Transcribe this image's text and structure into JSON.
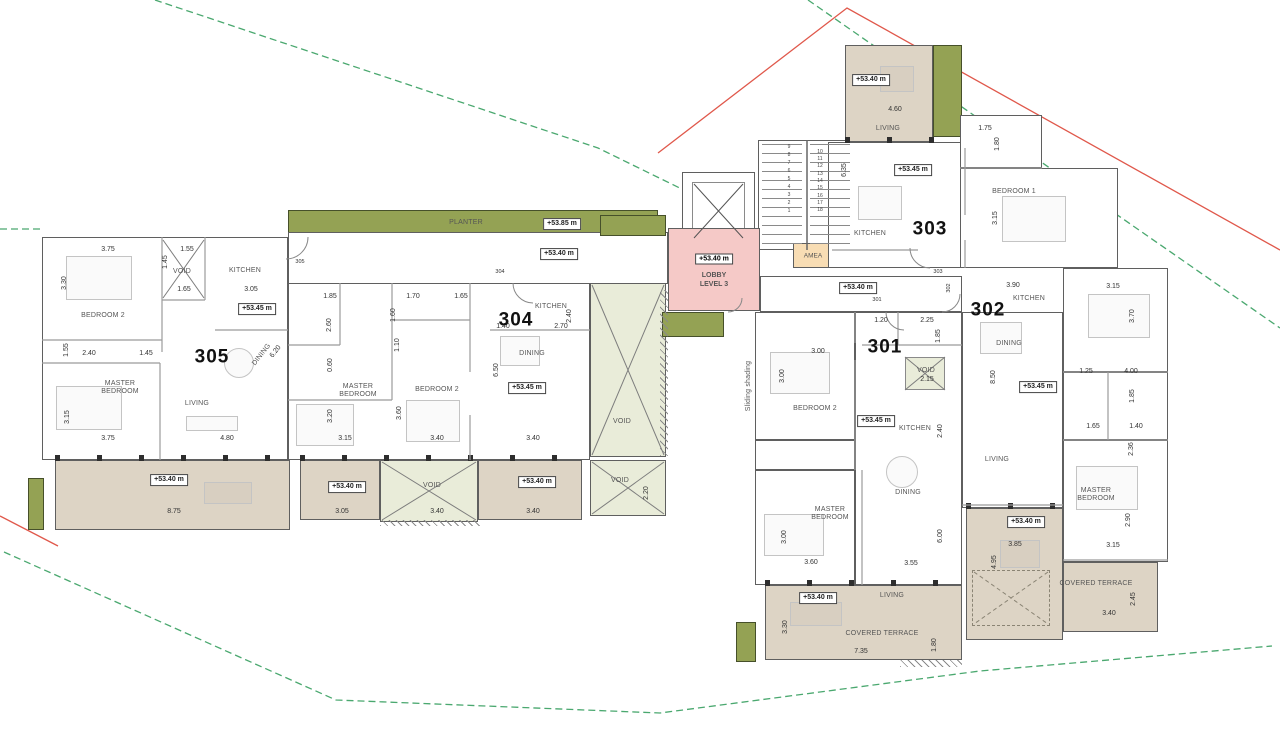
{
  "colors": {
    "terrace": "#ddd4c5",
    "planter": "#94a254",
    "void": "#e9ecd9",
    "lobby": "#f5c9c7",
    "amea": "#f8ddb4",
    "boundary_green": "#4aa86f",
    "boundary_red": "#e0584b"
  },
  "lobby": {
    "elevation": "+53.40 m",
    "line1": "LOBBY",
    "line2": "LEVEL 3"
  },
  "amea": {
    "label": "AMEA"
  },
  "labels": {
    "apartment_numbers": [
      {
        "t": "305",
        "x": 212,
        "y": 357
      },
      {
        "t": "304",
        "x": 516,
        "y": 320
      },
      {
        "t": "303",
        "x": 930,
        "y": 229
      },
      {
        "t": "302",
        "x": 988,
        "y": 310
      },
      {
        "t": "301",
        "x": 885,
        "y": 347
      }
    ],
    "rooms": [
      {
        "t": "BEDROOM 2",
        "x": 103,
        "y": 316
      },
      {
        "t": "VOID",
        "x": 182,
        "y": 272
      },
      {
        "t": "KITCHEN",
        "x": 245,
        "y": 271
      },
      {
        "t": "MASTER\nBEDROOM",
        "x": 120,
        "y": 388
      },
      {
        "t": "LIVING",
        "x": 197,
        "y": 404
      },
      {
        "t": "DINING",
        "x": 262,
        "y": 355,
        "r": -52
      },
      {
        "t": "PLANTER",
        "x": 466,
        "y": 223
      },
      {
        "t": "MASTER\nBEDROOM",
        "x": 358,
        "y": 391
      },
      {
        "t": "BEDROOM 2",
        "x": 437,
        "y": 390
      },
      {
        "t": "DINING",
        "x": 532,
        "y": 354
      },
      {
        "t": "KITCHEN",
        "x": 551,
        "y": 307
      },
      {
        "t": "VOID",
        "x": 432,
        "y": 486
      },
      {
        "t": "VOID",
        "x": 622,
        "y": 422
      },
      {
        "t": "VOID",
        "x": 620,
        "y": 481
      },
      {
        "t": "LIVING",
        "x": 888,
        "y": 129
      },
      {
        "t": "KITCHEN",
        "x": 870,
        "y": 234
      },
      {
        "t": "BEDROOM 1",
        "x": 1014,
        "y": 192
      },
      {
        "t": "KITCHEN",
        "x": 1029,
        "y": 299
      },
      {
        "t": "DINING",
        "x": 1009,
        "y": 344
      },
      {
        "t": "LIVING",
        "x": 997,
        "y": 460
      },
      {
        "t": "MASTER\nBEDROOM",
        "x": 1096,
        "y": 495
      },
      {
        "t": "COVERED TERRACE",
        "x": 1096,
        "y": 584
      },
      {
        "t": "BEDROOM 2",
        "x": 815,
        "y": 409
      },
      {
        "t": "VOID",
        "x": 926,
        "y": 371
      },
      {
        "t": "KITCHEN",
        "x": 915,
        "y": 429
      },
      {
        "t": "MASTER\nBEDROOM",
        "x": 830,
        "y": 514
      },
      {
        "t": "DINING",
        "x": 908,
        "y": 493
      },
      {
        "t": "LIVING",
        "x": 892,
        "y": 596
      },
      {
        "t": "COVERED TERRACE",
        "x": 882,
        "y": 634
      },
      {
        "t": "Sliding shading",
        "x": 749,
        "y": 386,
        "r": -90
      }
    ],
    "dims": [
      {
        "t": "3.75",
        "x": 108,
        "y": 250
      },
      {
        "t": "1.55",
        "x": 187,
        "y": 250
      },
      {
        "t": "1.45",
        "x": 166,
        "y": 262,
        "r": -90
      },
      {
        "t": "3.30",
        "x": 65,
        "y": 283,
        "r": -90
      },
      {
        "t": "1.65",
        "x": 184,
        "y": 290
      },
      {
        "t": "3.05",
        "x": 251,
        "y": 290
      },
      {
        "t": "1.55",
        "x": 67,
        "y": 350,
        "r": -90
      },
      {
        "t": "2.40",
        "x": 89,
        "y": 354
      },
      {
        "t": "1.45",
        "x": 146,
        "y": 354
      },
      {
        "t": "3.15",
        "x": 68,
        "y": 417,
        "r": -90
      },
      {
        "t": "3.75",
        "x": 108,
        "y": 439
      },
      {
        "t": "4.80",
        "x": 227,
        "y": 439
      },
      {
        "t": "8.75",
        "x": 174,
        "y": 512
      },
      {
        "t": "6.20",
        "x": 276,
        "y": 352,
        "r": -52
      },
      {
        "t": "1.85",
        "x": 330,
        "y": 297
      },
      {
        "t": "1.70",
        "x": 413,
        "y": 297
      },
      {
        "t": "1.65",
        "x": 461,
        "y": 297
      },
      {
        "t": "2.60",
        "x": 330,
        "y": 325,
        "r": -90
      },
      {
        "t": "1.60",
        "x": 394,
        "y": 315,
        "r": -90
      },
      {
        "t": "1.10",
        "x": 398,
        "y": 345,
        "r": -90
      },
      {
        "t": "0.60",
        "x": 331,
        "y": 365,
        "r": -90
      },
      {
        "t": "1.40",
        "x": 503,
        "y": 327
      },
      {
        "t": "2.70",
        "x": 561,
        "y": 327
      },
      {
        "t": "2.40",
        "x": 570,
        "y": 316,
        "r": -90
      },
      {
        "t": "3.20",
        "x": 331,
        "y": 416,
        "r": -90
      },
      {
        "t": "3.60",
        "x": 400,
        "y": 413,
        "r": -90
      },
      {
        "t": "3.15",
        "x": 345,
        "y": 439
      },
      {
        "t": "3.40",
        "x": 437,
        "y": 439
      },
      {
        "t": "3.40",
        "x": 533,
        "y": 439
      },
      {
        "t": "6.50",
        "x": 497,
        "y": 370,
        "r": -90
      },
      {
        "t": "3.05",
        "x": 342,
        "y": 512
      },
      {
        "t": "3.40",
        "x": 437,
        "y": 512
      },
      {
        "t": "3.40",
        "x": 533,
        "y": 512
      },
      {
        "t": "2.20",
        "x": 647,
        "y": 493,
        "r": -90
      },
      {
        "t": "6.35",
        "x": 845,
        "y": 170,
        "r": -90
      },
      {
        "t": "4.60",
        "x": 895,
        "y": 110
      },
      {
        "t": "1.75",
        "x": 985,
        "y": 129
      },
      {
        "t": "1.80",
        "x": 998,
        "y": 144,
        "r": -90
      },
      {
        "t": "3.15",
        "x": 996,
        "y": 218,
        "r": -90
      },
      {
        "t": "3.90",
        "x": 1013,
        "y": 286
      },
      {
        "t": "3.15",
        "x": 1113,
        "y": 287
      },
      {
        "t": "3.70",
        "x": 1133,
        "y": 316,
        "r": -90
      },
      {
        "t": "8.50",
        "x": 994,
        "y": 377,
        "r": -90
      },
      {
        "t": "1.25",
        "x": 1086,
        "y": 372
      },
      {
        "t": "4.00",
        "x": 1131,
        "y": 372
      },
      {
        "t": "1.85",
        "x": 1133,
        "y": 396,
        "r": -90
      },
      {
        "t": "1.65",
        "x": 1093,
        "y": 427
      },
      {
        "t": "1.40",
        "x": 1136,
        "y": 427
      },
      {
        "t": "2.36",
        "x": 1132,
        "y": 449,
        "r": -90
      },
      {
        "t": "2.90",
        "x": 1129,
        "y": 520,
        "r": -90
      },
      {
        "t": "3.15",
        "x": 1113,
        "y": 546
      },
      {
        "t": "3.85",
        "x": 1015,
        "y": 545
      },
      {
        "t": "4.95",
        "x": 995,
        "y": 562,
        "r": -90
      },
      {
        "t": "3.40",
        "x": 1109,
        "y": 614
      },
      {
        "t": "2.45",
        "x": 1134,
        "y": 599,
        "r": -90
      },
      {
        "t": "1.20",
        "x": 881,
        "y": 321
      },
      {
        "t": "2.25",
        "x": 927,
        "y": 321
      },
      {
        "t": "1.85",
        "x": 939,
        "y": 336,
        "r": -90
      },
      {
        "t": "3.00",
        "x": 818,
        "y": 352
      },
      {
        "t": "3.00",
        "x": 783,
        "y": 376,
        "r": -90
      },
      {
        "t": "2.15",
        "x": 927,
        "y": 380
      },
      {
        "t": "2.40",
        "x": 941,
        "y": 431,
        "r": -90
      },
      {
        "t": "3.00",
        "x": 785,
        "y": 537,
        "r": -90
      },
      {
        "t": "3.60",
        "x": 811,
        "y": 563
      },
      {
        "t": "6.00",
        "x": 941,
        "y": 536,
        "r": -90
      },
      {
        "t": "3.55",
        "x": 911,
        "y": 564
      },
      {
        "t": "3.30",
        "x": 786,
        "y": 627,
        "r": -90
      },
      {
        "t": "7.35",
        "x": 861,
        "y": 652
      },
      {
        "t": "1.80",
        "x": 935,
        "y": 645,
        "r": -90
      }
    ],
    "elevations": [
      {
        "t": "+53.85 m",
        "x": 562,
        "y": 224
      },
      {
        "t": "+53.40 m",
        "x": 559,
        "y": 254
      },
      {
        "t": "+53.45 m",
        "x": 257,
        "y": 309
      },
      {
        "t": "+53.40 m",
        "x": 169,
        "y": 480
      },
      {
        "t": "+53.45 m",
        "x": 527,
        "y": 388
      },
      {
        "t": "+53.40 m",
        "x": 347,
        "y": 487
      },
      {
        "t": "+53.40 m",
        "x": 537,
        "y": 482
      },
      {
        "t": "+53.40 m",
        "x": 858,
        "y": 288
      },
      {
        "t": "+53.40 m",
        "x": 871,
        "y": 80
      },
      {
        "t": "+53.45 m",
        "x": 913,
        "y": 170
      },
      {
        "t": "+53.45 m",
        "x": 1038,
        "y": 387
      },
      {
        "t": "+53.45 m",
        "x": 876,
        "y": 421
      },
      {
        "t": "+53.40 m",
        "x": 818,
        "y": 598
      },
      {
        "t": "+53.40 m",
        "x": 1026,
        "y": 522
      }
    ],
    "door_tags": [
      {
        "t": "305",
        "x": 300,
        "y": 262
      },
      {
        "t": "304",
        "x": 500,
        "y": 272
      },
      {
        "t": "303",
        "x": 938,
        "y": 272
      },
      {
        "t": "301",
        "x": 877,
        "y": 300
      },
      {
        "t": "302",
        "x": 949,
        "y": 288,
        "r": -90
      }
    ],
    "stair_steps": [
      {
        "t": "1",
        "x": 789,
        "y": 212
      },
      {
        "t": "2",
        "x": 789,
        "y": 204
      },
      {
        "t": "3",
        "x": 789,
        "y": 196
      },
      {
        "t": "4",
        "x": 789,
        "y": 188
      },
      {
        "t": "5",
        "x": 789,
        "y": 180
      },
      {
        "t": "6",
        "x": 789,
        "y": 172
      },
      {
        "t": "7",
        "x": 789,
        "y": 164
      },
      {
        "t": "8",
        "x": 789,
        "y": 156
      },
      {
        "t": "9",
        "x": 789,
        "y": 148
      },
      {
        "t": "10",
        "x": 820,
        "y": 153
      },
      {
        "t": "11",
        "x": 820,
        "y": 160
      },
      {
        "t": "12",
        "x": 820,
        "y": 167
      },
      {
        "t": "13",
        "x": 820,
        "y": 175
      },
      {
        "t": "14",
        "x": 820,
        "y": 182
      },
      {
        "t": "15",
        "x": 820,
        "y": 189
      },
      {
        "t": "16",
        "x": 820,
        "y": 197
      },
      {
        "t": "17",
        "x": 820,
        "y": 204
      },
      {
        "t": "18",
        "x": 820,
        "y": 211
      }
    ]
  }
}
